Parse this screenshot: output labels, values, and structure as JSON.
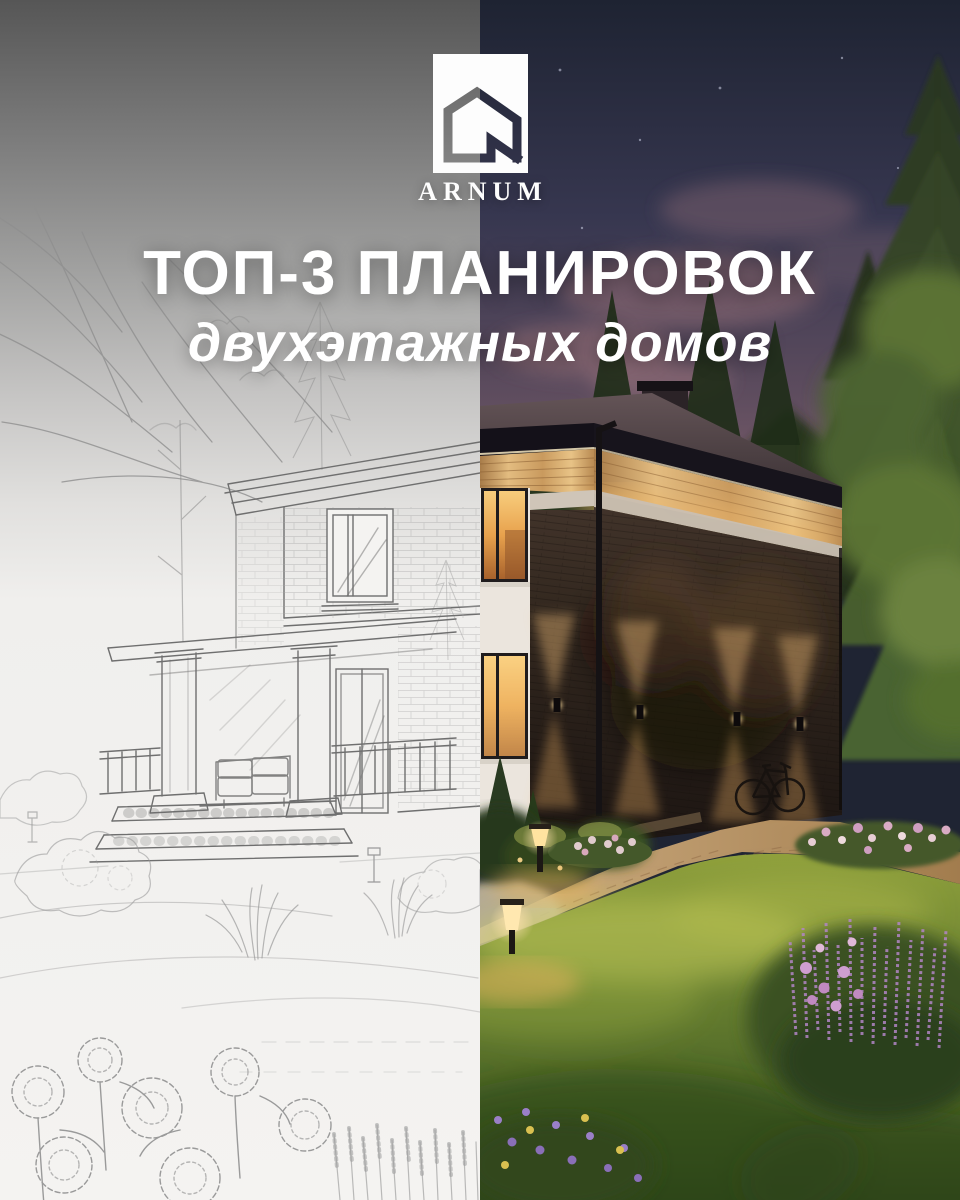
{
  "poster": {
    "brand": {
      "name": "ARNUM",
      "logo_icon": "house-monogram-icon"
    },
    "headline": {
      "title": "ТОП-3 ПЛАНИРОВОК",
      "subtitle": "двухэтажных домов"
    },
    "artwork": {
      "left_half": "pencil-sketch concept of two-story house with porch and garden",
      "right_half": "photorealistic dusk render of same house with lit facade and garden"
    },
    "palette": {
      "text": "#ffffff",
      "sky_top": "#1e2332",
      "sky_dusk": "#5d4c5e",
      "cloud_pink": "#8a6572",
      "forest": "#26351d",
      "pine": "#3a4d29",
      "foliage_lit": "#6d8440",
      "roof": "#564a4c",
      "fascia": "#15131a",
      "wood_band": "#d8a968",
      "brick": "#2c221c",
      "stripe": "#cfc5b8",
      "window_glow": "#f2b863",
      "sconce_glow": "#f4c27e",
      "lawn_lit": "#b5bd4e",
      "lawn": "#5d7a2e",
      "lawn_dark": "#33491c",
      "flowers_pink": "#cf9ed0",
      "flowers_purple": "#9a7fc8",
      "path": "#c89f6d",
      "sketch_paper": "#f1f0ee",
      "sketch_line": "#8f8f8f",
      "sketch_gray_top": "#565656"
    }
  }
}
